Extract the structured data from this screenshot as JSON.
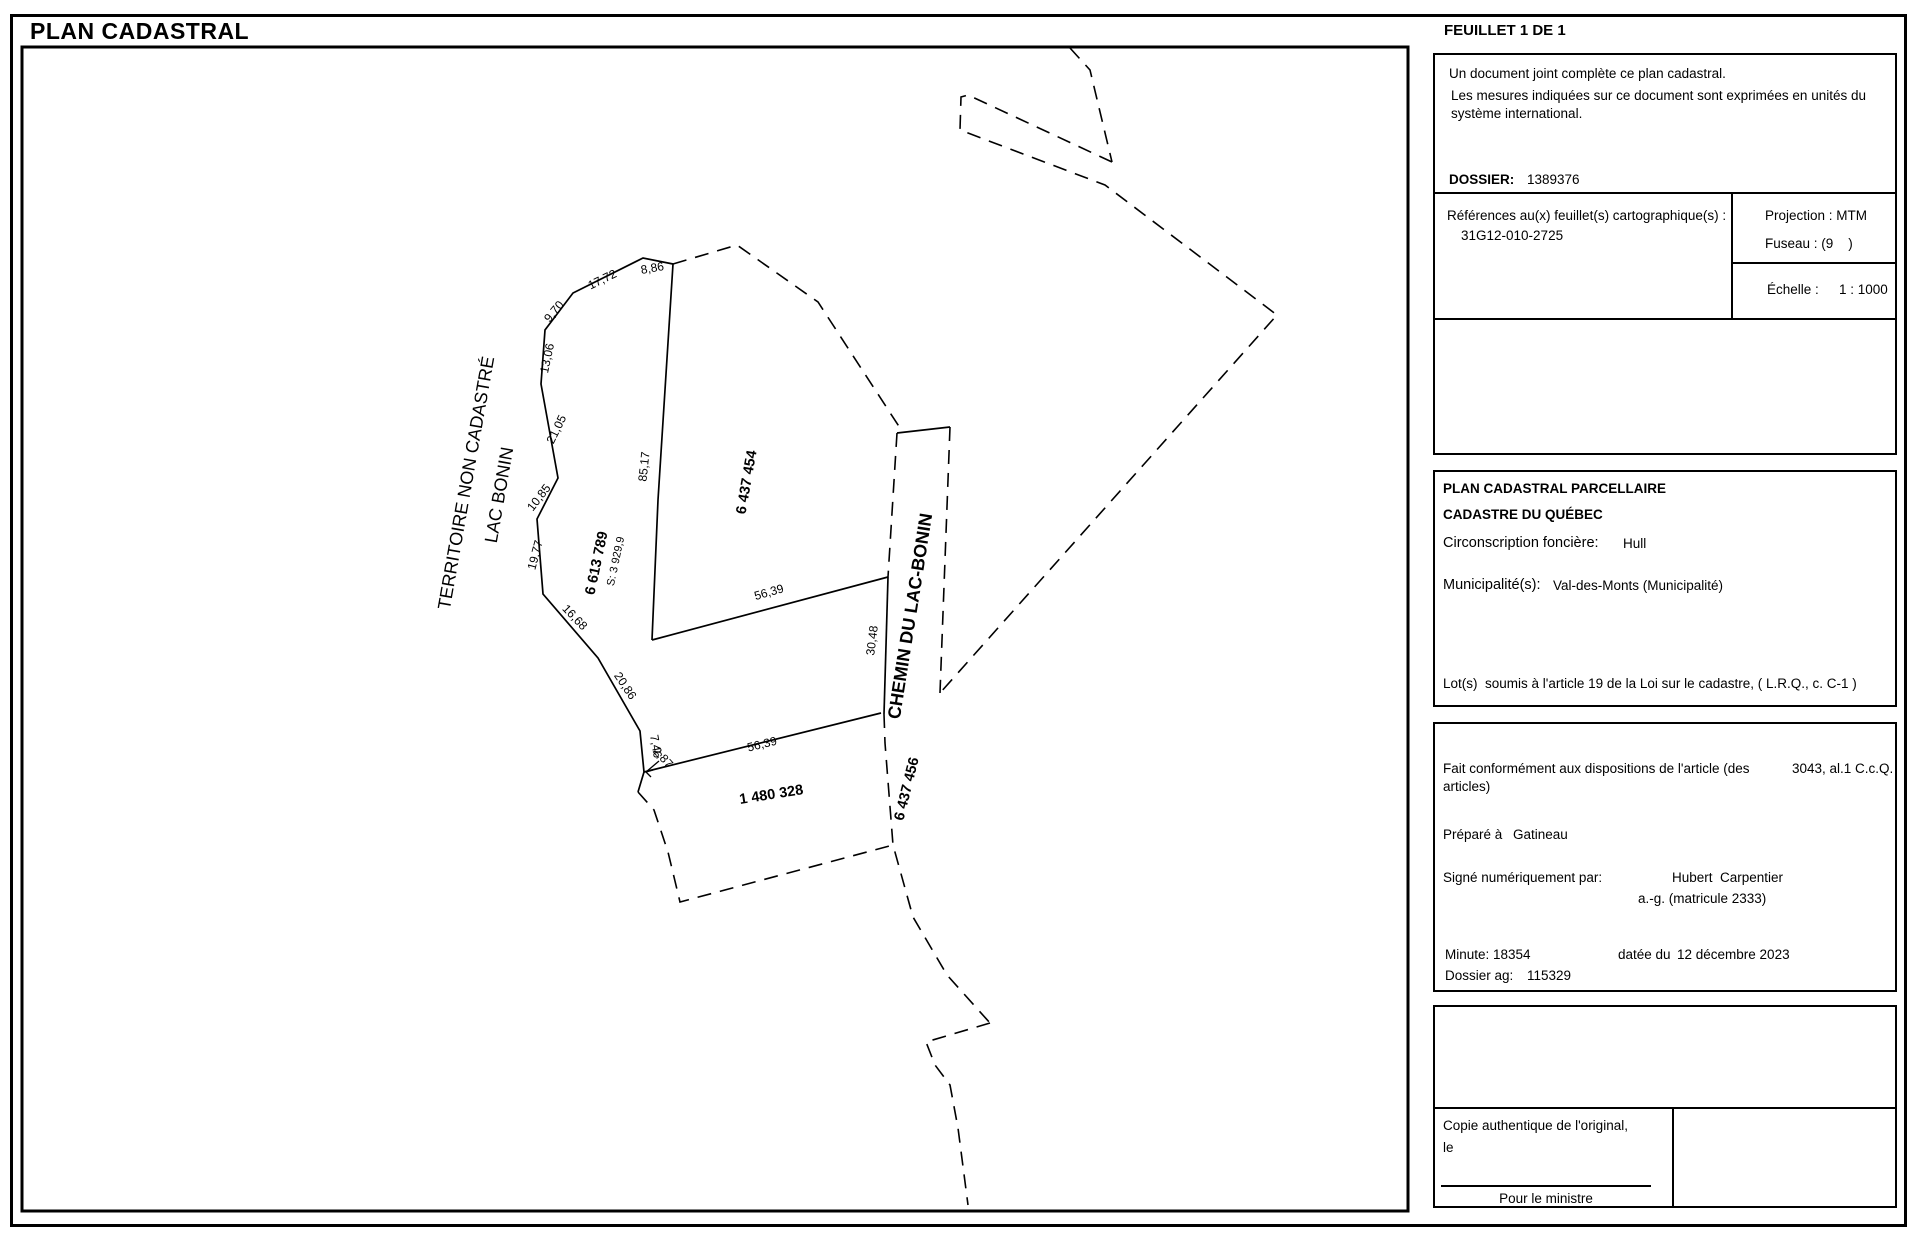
{
  "page": {
    "title": "PLAN CADASTRAL",
    "feuillet": "FEUILLET 1 DE 1"
  },
  "colors": {
    "ink": "#000000",
    "paper": "#ffffff"
  },
  "info_box": {
    "line1": "Un document joint complète ce plan cadastral.",
    "line2": "Les mesures indiquées sur ce document sont exprimées en unités du système international.",
    "dossier_label": "DOSSIER:",
    "dossier_value": "1389376"
  },
  "references_box": {
    "label": "Références au(x) feuillet(s) cartographique(s) :",
    "value": "31G12-010-2725",
    "projection": "Projection : MTM",
    "fuseau": "Fuseau : (9    )",
    "echelle_label": "Échelle :",
    "echelle_value": "1 : 1000"
  },
  "title_box": {
    "line1": "PLAN CADASTRAL PARCELLAIRE",
    "line2": "CADASTRE DU QUÉBEC",
    "circonscription_label": "Circonscription foncière:",
    "circonscription_value": "Hull",
    "municipalite_label": "Municipalité(s):",
    "municipalite_value": "Val-des-Monts (Municipalité)",
    "lots_note": "Lot(s)  soumis à l'article 19 de la Loi sur le cadastre, ( L.R.Q., c. C-1 )"
  },
  "certification_box": {
    "fait_label": "Fait conformément aux dispositions de l'article (des articles)",
    "fait_value": "3043, al.1 C.c.Q.",
    "prepare_label": "Préparé à",
    "prepare_value": "Gatineau",
    "signe_label": "Signé numériquement par:",
    "signe_name": "Hubert  Carpentier",
    "signe_title": "a.-g. (matricule 2333)",
    "minute_label": "Minute: 18354",
    "date_label": "datée du",
    "date_value": "12 décembre 2023",
    "dossier_ag_label": "Dossier ag:",
    "dossier_ag_value": "115329"
  },
  "copy_box": {
    "line1": "Copie authentique de l'original,",
    "line2": "le",
    "minister_label": "Pour le ministre"
  },
  "map": {
    "territory_line1": "TERRITOIRE NON CADASTRÉ",
    "territory_line2": "LAC BONIN",
    "road_label": "CHEMIN DU LAC-BONIN",
    "lots": [
      {
        "number": "6 613 789",
        "area": "S: 3 929,9"
      },
      {
        "number": "6 437 454"
      },
      {
        "number": "1 480 328"
      },
      {
        "number": "6 437 456"
      }
    ],
    "measurements": [
      "8,86",
      "17,72",
      "9,70",
      "13,06",
      "21,05",
      "10,85",
      "19,77",
      "16,68",
      "20,86",
      "7,46",
      "2,87",
      "85,17",
      "56,39",
      "30,48",
      "56,39"
    ]
  }
}
